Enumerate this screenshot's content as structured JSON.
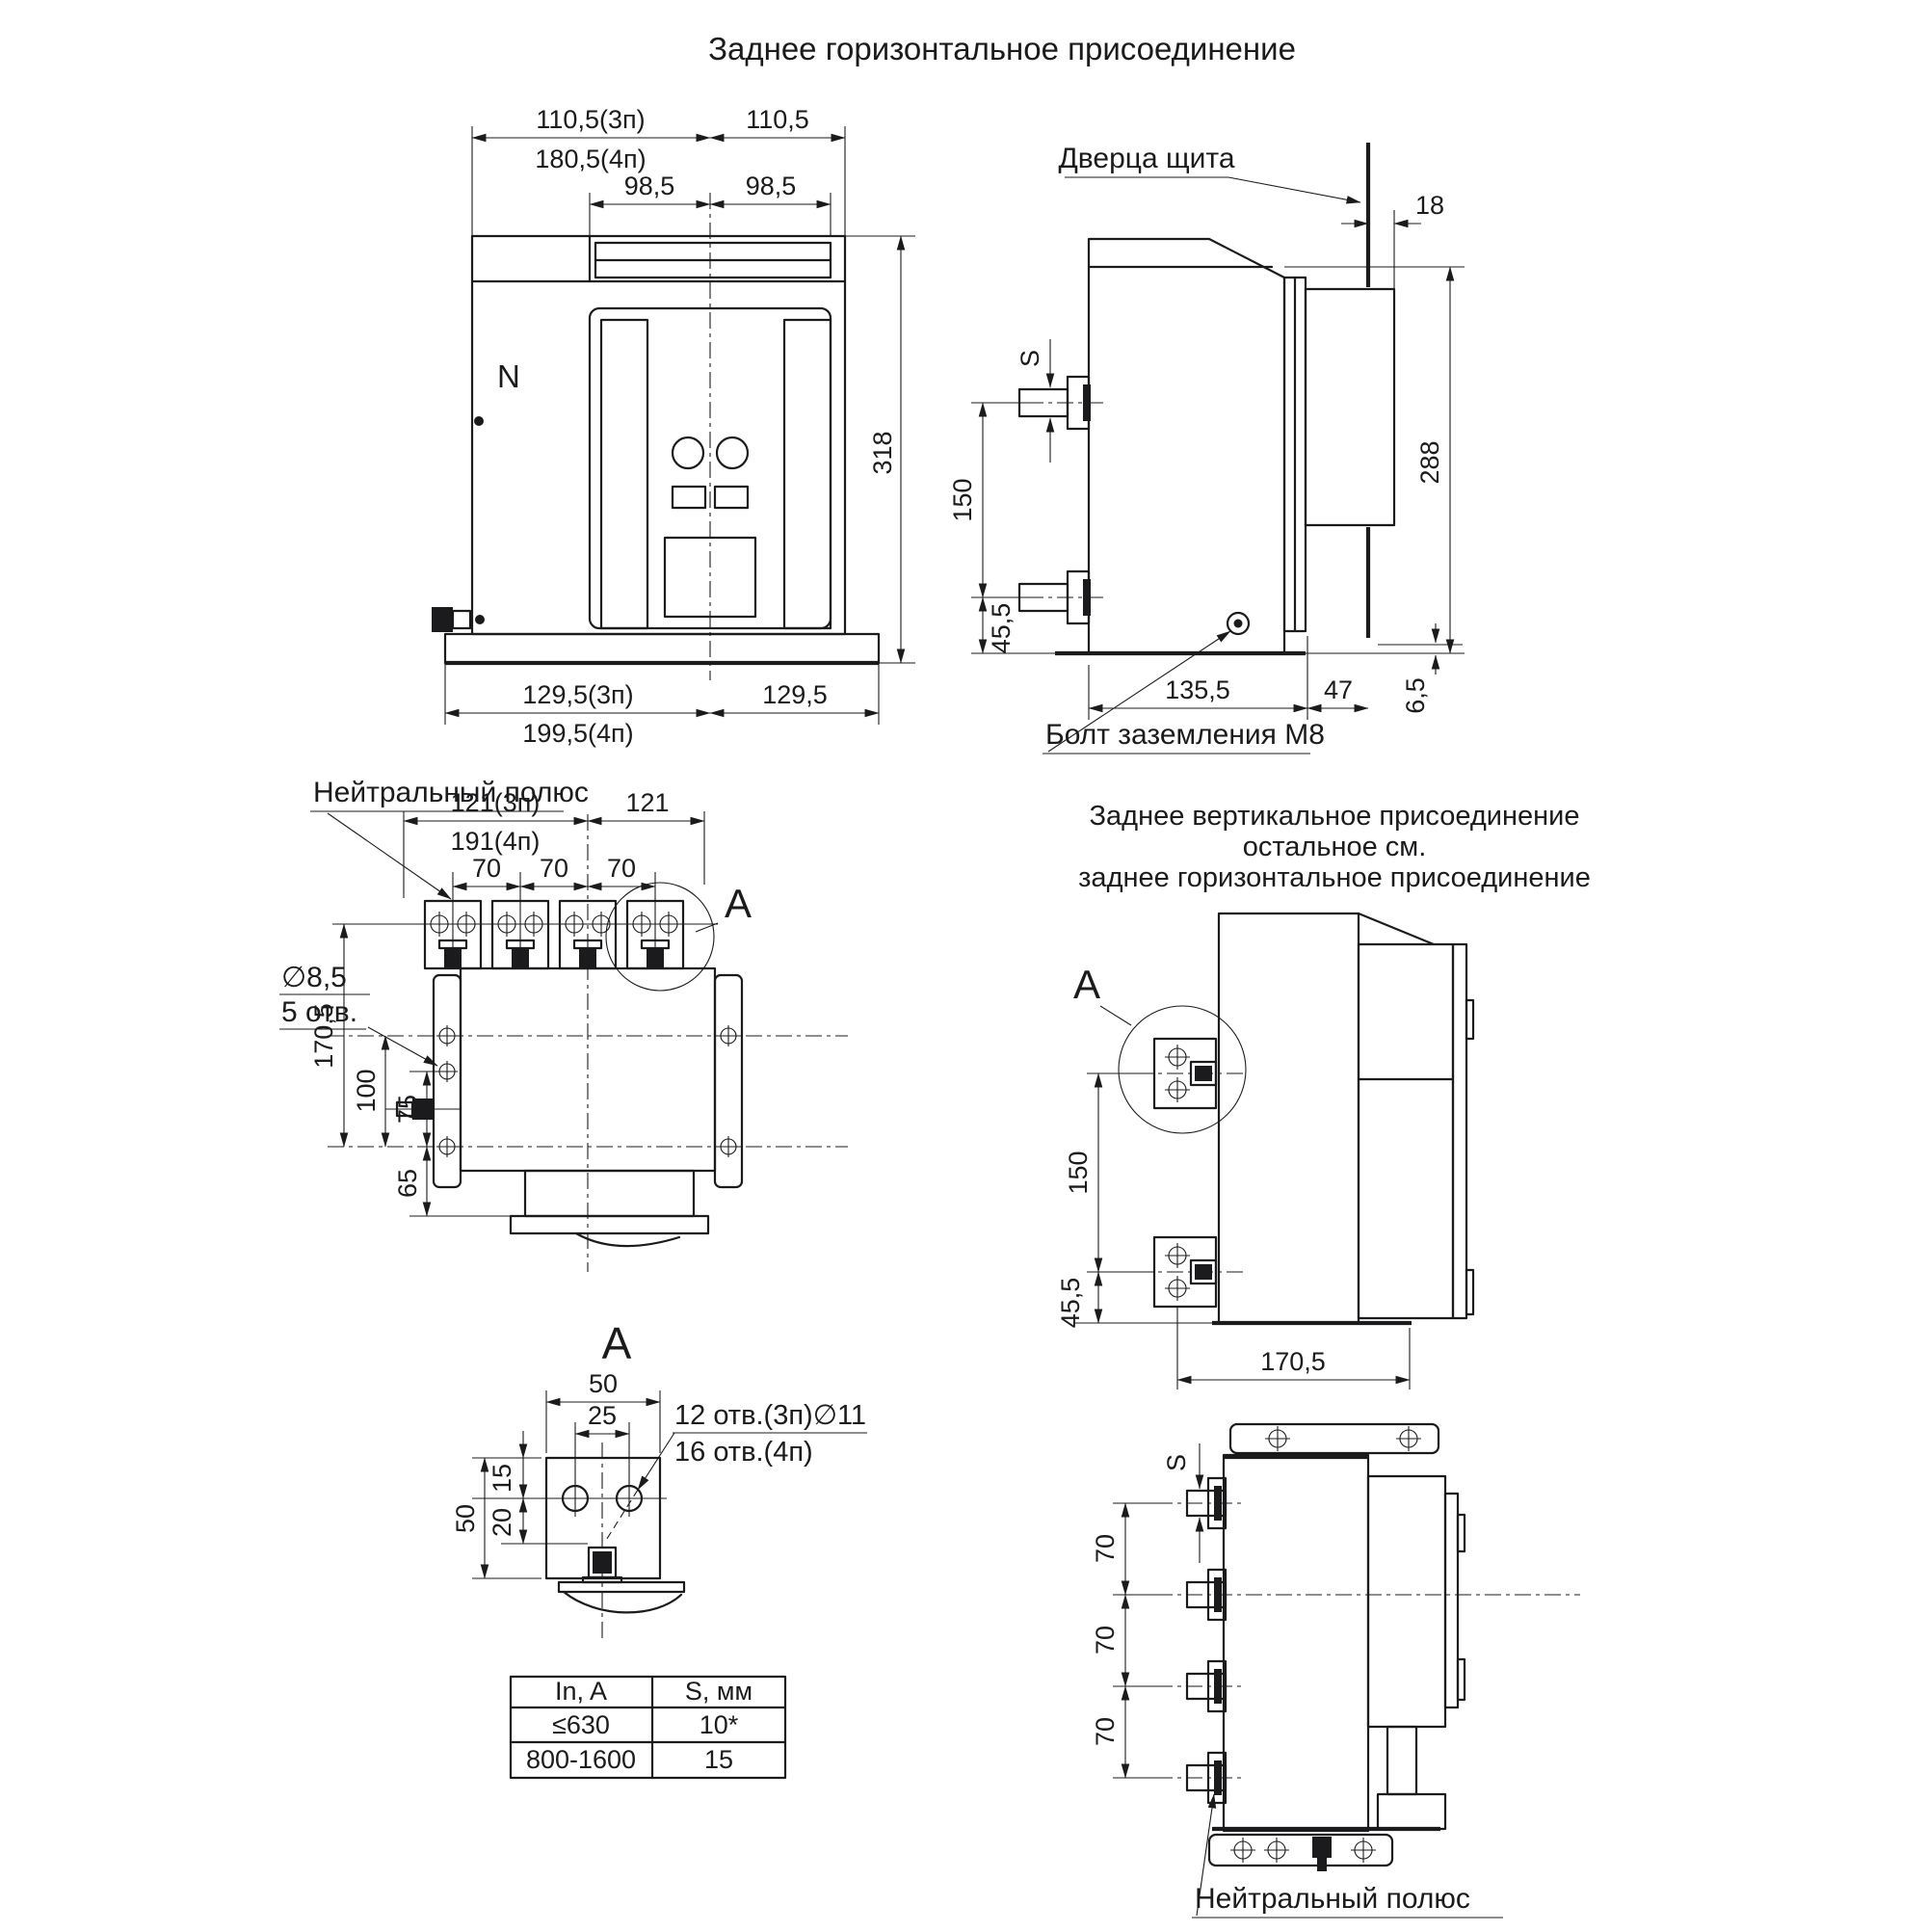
{
  "page_title": "Заднее горизонтальное присоединение",
  "front_view": {
    "dim_top_w1_3p": "110,5(3п)",
    "dim_top_w1_4p": "180,5(4п)",
    "dim_top_w2": "110,5",
    "dim_inner_left": "98,5",
    "dim_inner_right": "98,5",
    "dim_height": "318",
    "dim_bottom_w1_3p": "129,5(3п)",
    "dim_bottom_w1_4p": "199,5(4п)",
    "dim_bottom_w2": "129,5",
    "neutral_marker": "N"
  },
  "side_view": {
    "door_label": "Дверца щита",
    "dim_protrusion": "18",
    "terminal_thickness": "S",
    "dim_terminal_spacing": "150",
    "dim_terminal_to_base": "45,5",
    "dim_height": "288",
    "dim_depth": "135,5",
    "dim_front": "47",
    "dim_gap": "6,5",
    "ground_bolt_label": "Болт заземления М8"
  },
  "top_view": {
    "neutral_pole_label": "Нейтральный полюс",
    "dim_w1_3p": "121(3п)",
    "dim_w1_4p": "191(4п)",
    "dim_w2": "121",
    "dim_pole_pitch_1": "70",
    "dim_pole_pitch_2": "70",
    "dim_pole_pitch_3": "70",
    "detail_mark": "А",
    "hole_dia": "∅8,5",
    "hole_count": "5 отв.",
    "dim_depth_total": "170,5",
    "dim_depth_100": "100",
    "dim_depth_75": "75",
    "dim_depth_65": "65"
  },
  "vertical_view": {
    "title_line1": "Заднее вертикальное присоединение",
    "title_line2": "остальное см.",
    "title_line3": "заднее горизонтальное присоединение",
    "detail_mark": "А",
    "dim_terminal_spacing": "150",
    "dim_terminal_to_base": "45,5",
    "dim_depth": "170,5"
  },
  "detail_a": {
    "title": "А",
    "dim_width": "50",
    "dim_hole_spacing": "25",
    "dim_top_to_holes": "15",
    "dim_holes_to_pad": "20",
    "dim_height": "50",
    "holes_note_line1": "12 отв.(3п)∅11",
    "holes_note_line2": "16 отв.(4п)"
  },
  "spec_table": {
    "col1_header": "In, A",
    "col2_header": "S, мм",
    "rows": [
      {
        "current": "≤630",
        "thickness": "10*"
      },
      {
        "current": "800-1600",
        "thickness": "15"
      }
    ]
  },
  "bottom_view": {
    "terminal_thickness": "S",
    "dim_pole_pitch_1": "70",
    "dim_pole_pitch_2": "70",
    "dim_pole_pitch_3": "70",
    "neutral_pole_label": "Нейтральный полюс"
  }
}
